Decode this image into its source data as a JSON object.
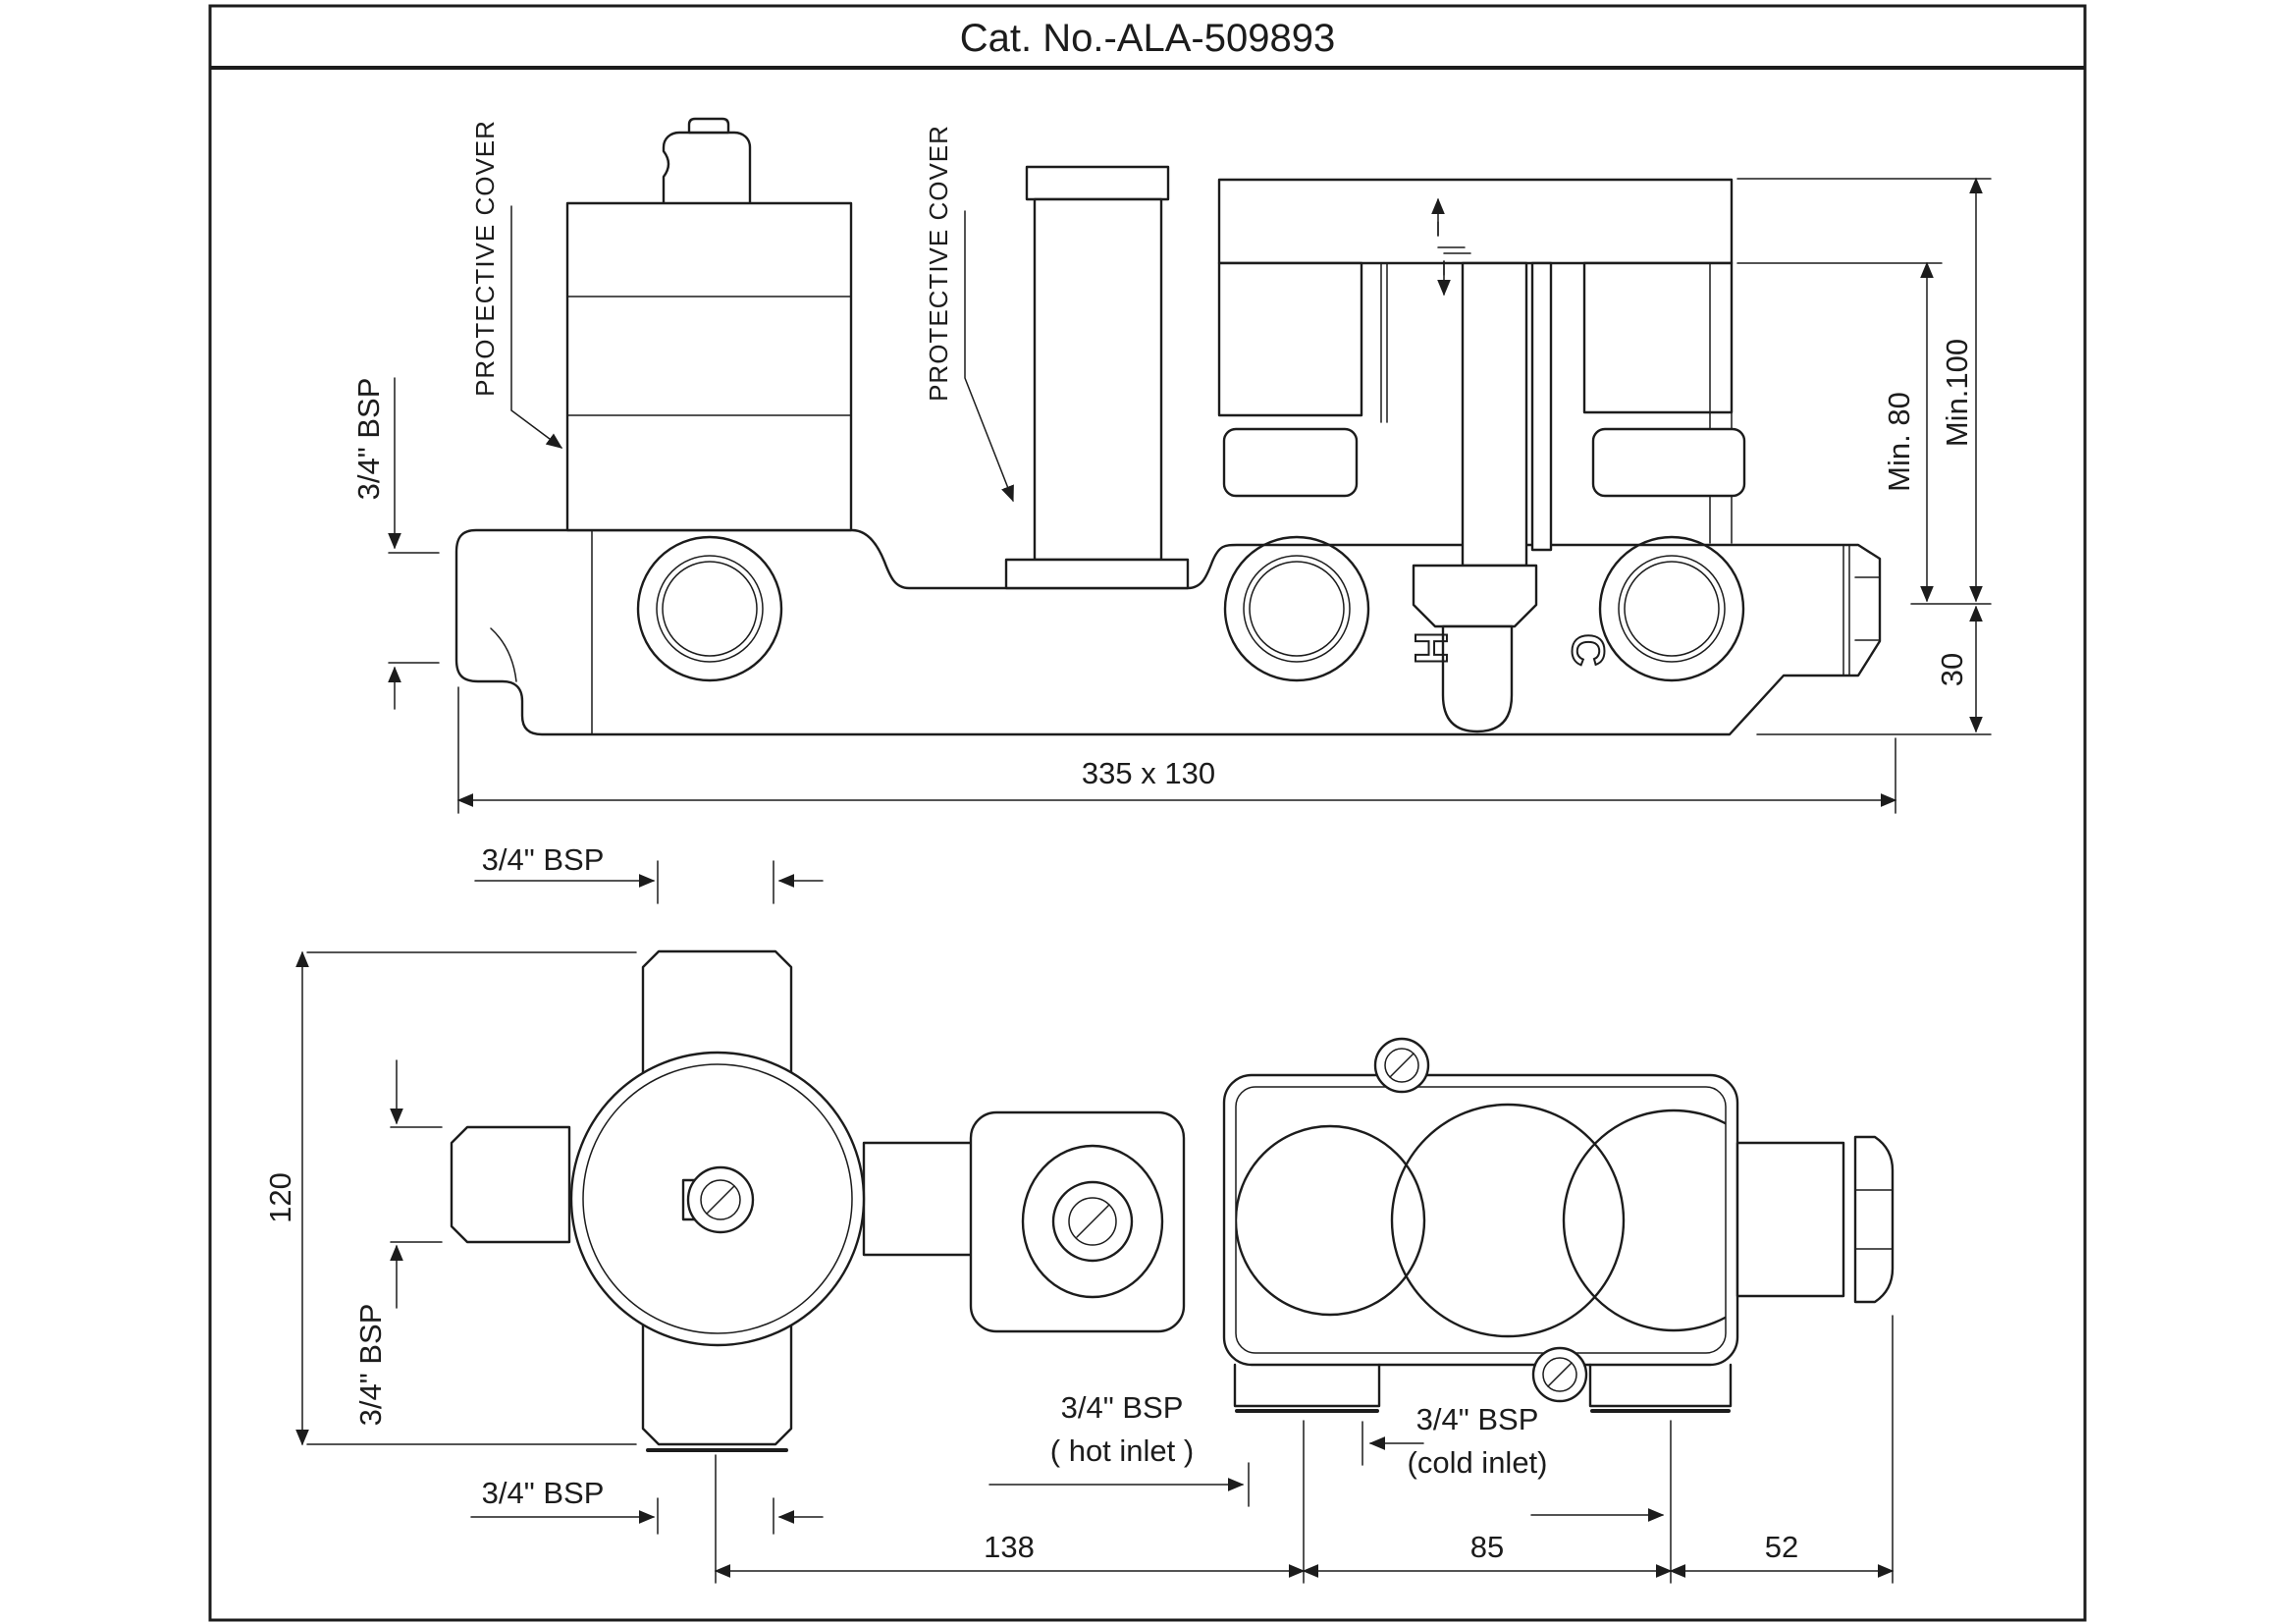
{
  "title": "Cat. No.-ALA-509893",
  "colors": {
    "line": "#1c1c1c",
    "background": "#ffffff"
  },
  "top_view": {
    "labels": {
      "protective_cover_1": "PROTECTIVE COVER",
      "protective_cover_2": "PROTECTIVE COVER",
      "bsp_left_port": "3/4\" BSP",
      "min_depth_80": "Min. 80",
      "min_depth_100": "Min.100",
      "dim_centerline_to_bottom": "30",
      "dim_overall": "335 x 130",
      "hot_marking": "H",
      "cold_marking": "C"
    }
  },
  "bottom_view": {
    "labels": {
      "dim_height": "120",
      "bsp_top_port": "3/4\" BSP",
      "bsp_left_port": "3/4\" BSP",
      "bsp_bottom_port": "3/4\" BSP",
      "hot_inlet_line1": "3/4\" BSP",
      "hot_inlet_line2": "( hot inlet )",
      "cold_inlet_line1": "3/4\" BSP",
      "cold_inlet_line2": "(cold inlet)",
      "dim_hot_to_cold": "138",
      "dim_cold_to_plate": "85",
      "dim_plate_to_outlet": "52"
    }
  }
}
